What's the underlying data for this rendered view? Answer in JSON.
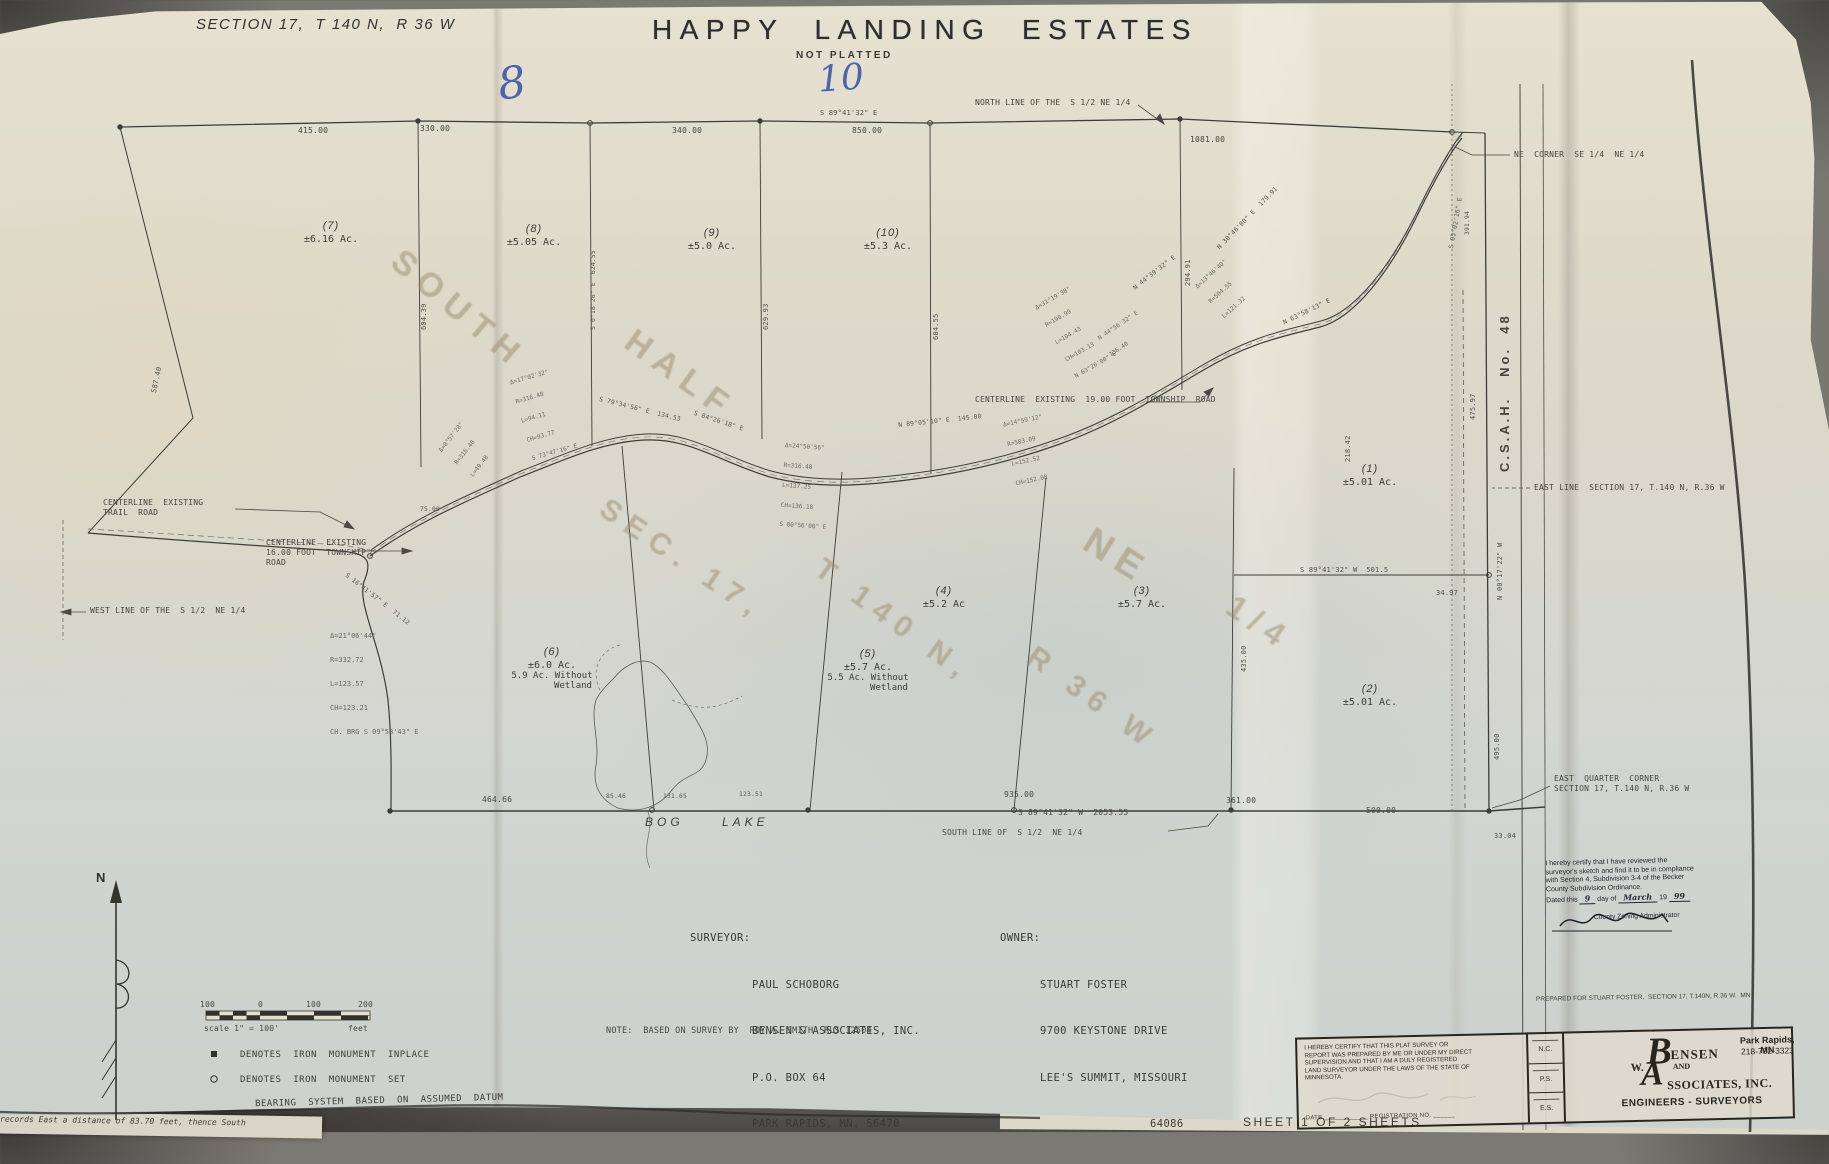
{
  "header": {
    "section": "SECTION 17,  T 140 N,  R 36 W",
    "title": "HAPPY  LANDING  ESTATES",
    "subtitle": "NOT  PLATTED"
  },
  "handwriting": {
    "eight": "8",
    "ten": "10"
  },
  "ghost": {
    "south": "SOUTH",
    "half": "HALF",
    "sec": "SEC. 17,",
    "twp": "T 140 N,",
    "rng": "R 36 W",
    "ne": "NE",
    "quarter": "1/4"
  },
  "labels": {
    "north_line": "NORTH LINE OF THE  S 1/2 NE 1/4",
    "south_line": "SOUTH LINE OF  S 1/2  NE 1/4",
    "west_line": "WEST LINE OF THE  S 1/2  NE 1/4",
    "east_line": "EAST LINE  SECTION 17, T.140 N, R.36 W",
    "east_quarter_corner_1": "EAST  QUARTER  CORNER",
    "east_quarter_corner_2": "SECTION 17, T.140 N, R.36 W",
    "ne_corner": "NE  CORNER  SE 1/4  NE 1/4",
    "csah": "C.S.A.H.   No.  48",
    "centerline_trail_1": "CENTERLINE  EXISTING",
    "centerline_trail_2": "TRAIL  ROAD",
    "centerline_16_1": "CENTERLINE  EXISTING",
    "centerline_16_2": "16.00 FOOT  TOWNSHIP",
    "centerline_16_3": "ROAD",
    "centerline_19": "CENTERLINE  EXISTING  19.00 FOOT  TOWNSHIP  ROAD",
    "bog": "BOG",
    "lake": "LAKE"
  },
  "marker": "±",
  "lots": [
    {
      "num": "(7)",
      "ac": "6.16 Ac."
    },
    {
      "num": "(8)",
      "ac": "5.05 Ac."
    },
    {
      "num": "(9)",
      "ac": "5.0 Ac."
    },
    {
      "num": "(10)",
      "ac": "5.3 Ac."
    },
    {
      "num": "(1)",
      "ac": "5.01 Ac."
    },
    {
      "num": "(2)",
      "ac": "5.01 Ac."
    },
    {
      "num": "(3)",
      "ac": "5.7 Ac."
    },
    {
      "num": "(4)",
      "ac": "5.2 Ac"
    },
    {
      "num": "(5)",
      "ac": "5.7 Ac.",
      "ac2": "5.5 Ac. Without",
      "ac3": "Wetland"
    },
    {
      "num": "(6)",
      "ac": "6.0 Ac.",
      "ac2": "5.9 Ac. Without",
      "ac3": "Wetland"
    }
  ],
  "dims": [
    "415.00",
    "330.00",
    "340.00",
    "S 89°41'32\" E",
    "850.00",
    "1081.00",
    "464.66",
    "85.46",
    "131.65",
    "123.51",
    "935.00",
    "S 89°41'32\" W  2053.55",
    "361.00",
    "500.00",
    "33.04",
    "34.97",
    "S 89°41'32\" W  501.5",
    "475.97",
    "N 00°17'22\" W",
    "495.00",
    "218.42",
    "435.00",
    "604.39",
    "S 0°18'26\" E  624.55",
    "629.93",
    "604.55",
    "294.91",
    "587.40",
    "S 16°41'57\" E  71.12",
    "75.00",
    "N 89°05'10\" E  145.00",
    "S 79°34'56\" E  134.53",
    "S 84°26'18\" E",
    "N 44°39'32\" E",
    "N 30°46'00\" E  179.91",
    "N 63°58'13\" E",
    "S 03°02'16\" E",
    "391.94"
  ],
  "clusters": [
    [
      "Δ=17°02'32\"",
      "R=316.48",
      "L=94.11",
      "CH=93.77",
      "S 73°47'16\" E"
    ],
    [
      "Δ=24°50'56\"",
      "R=316.48",
      "L=137.25",
      "CH=136.18",
      "S 80°56'00\" E"
    ],
    [
      "Δ=14°59'12\"",
      "R=583.09",
      "L=152.52",
      "CH=152.08"
    ],
    [
      "Δ=31°19'38\"",
      "R=190.99",
      "L=104.43",
      "CH=103.13",
      "N 63°26'00\" E"
    ],
    [
      "N 44°56'32\" E",
      "136.40"
    ],
    [
      "Δ=21°06'44\"",
      "R=332.72",
      "L=123.57",
      "CH=123.21",
      "CH. BRG S 09°58'43\" E"
    ],
    [
      "Δ=13°46'40\"",
      "R=504.55",
      "L=121.32"
    ],
    [
      "Δ=8°57'28\"",
      "R=316.48",
      "L=49.48"
    ]
  ],
  "scalebar": {
    "n100a": "100",
    "n0": "0",
    "n100b": "100",
    "n200": "200",
    "caption": "scale 1\" = 100'",
    "unit": "feet"
  },
  "legend": {
    "sym_inplace": "●",
    "inplace": "DENOTES  IRON  MONUMENT  INPLACE",
    "sym_set": "O",
    "set": "DENOTES  IRON  MONUMENT  SET",
    "bearing": "BEARING  SYSTEM  BASED  ON  ASSUMED  DATUM"
  },
  "compass": {
    "n": "N"
  },
  "surveyor": {
    "label": "SURVEYOR:",
    "l1": "PAUL SCHOBORG",
    "l2": "BENSEN & ASSOCIATES, INC.",
    "l3": "P.O. BOX 64",
    "l4": "PARK RAPIDS, MN. 56470"
  },
  "owner": {
    "label": "OWNER:",
    "l1": "STUART FOSTER",
    "l2": "9700 KEYSTONE DRIVE",
    "l3": "LEE'S SUMMIT, MISSOURI",
    "l4": "64086"
  },
  "note": "NOTE:  BASED ON SURVEY BY  ROY A. SMITH  RLS 12504",
  "prepared_for": "PREPARED FOR STUART FOSTER,  SECTION 17, T.140N, R.36 W.  MN",
  "stamp": {
    "l1": "I hereby certify that I have reviewed the",
    "l2": "surveyor's sketch and find it to be in compliance",
    "l3": "with Section 4, Subdivision 3-4 of the Becker",
    "l4": "County Subdivision Ordinance.",
    "dated_pre": "Dated this",
    "day": "9",
    "mid": "day of",
    "month": "March",
    "yr": "19",
    "year": "99",
    "caption": "County Zoning Administrator"
  },
  "titleblock": {
    "cert_l1": "I HEREBY CERTIFY THAT THIS PLAT SURVEY OR",
    "cert_l2": "REPORT WAS PREPARED BY ME OR UNDER MY DIRECT",
    "cert_l3": "SUPERVISION AND THAT I AM A DULY REGISTERED",
    "cert_l4": "LAND SURVEYOR UNDER THE LAWS OF THE STATE OF",
    "cert_l5": "MINNESOTA.",
    "date_label": "DATE",
    "reg_label": "REGISTRATION NO.",
    "init_1": "N.C.",
    "init_2": "P.S.",
    "init_3": "E.S.",
    "logo_w": "W.",
    "logo_b": "B",
    "logo_ensen": "ENSEN",
    "logo_and": "AND",
    "logo_a": "A",
    "logo_ssoc": "SSOCIATES, INC.",
    "tagline": "ENGINEERS - SURVEYORS",
    "city": "Park Rapids, MN",
    "phone": "218-732-3323"
  },
  "sheet_note": "SHEET  1  OF  2  SHEETS",
  "edge_note": "records East a distance of 83.70 feet, thence South"
}
